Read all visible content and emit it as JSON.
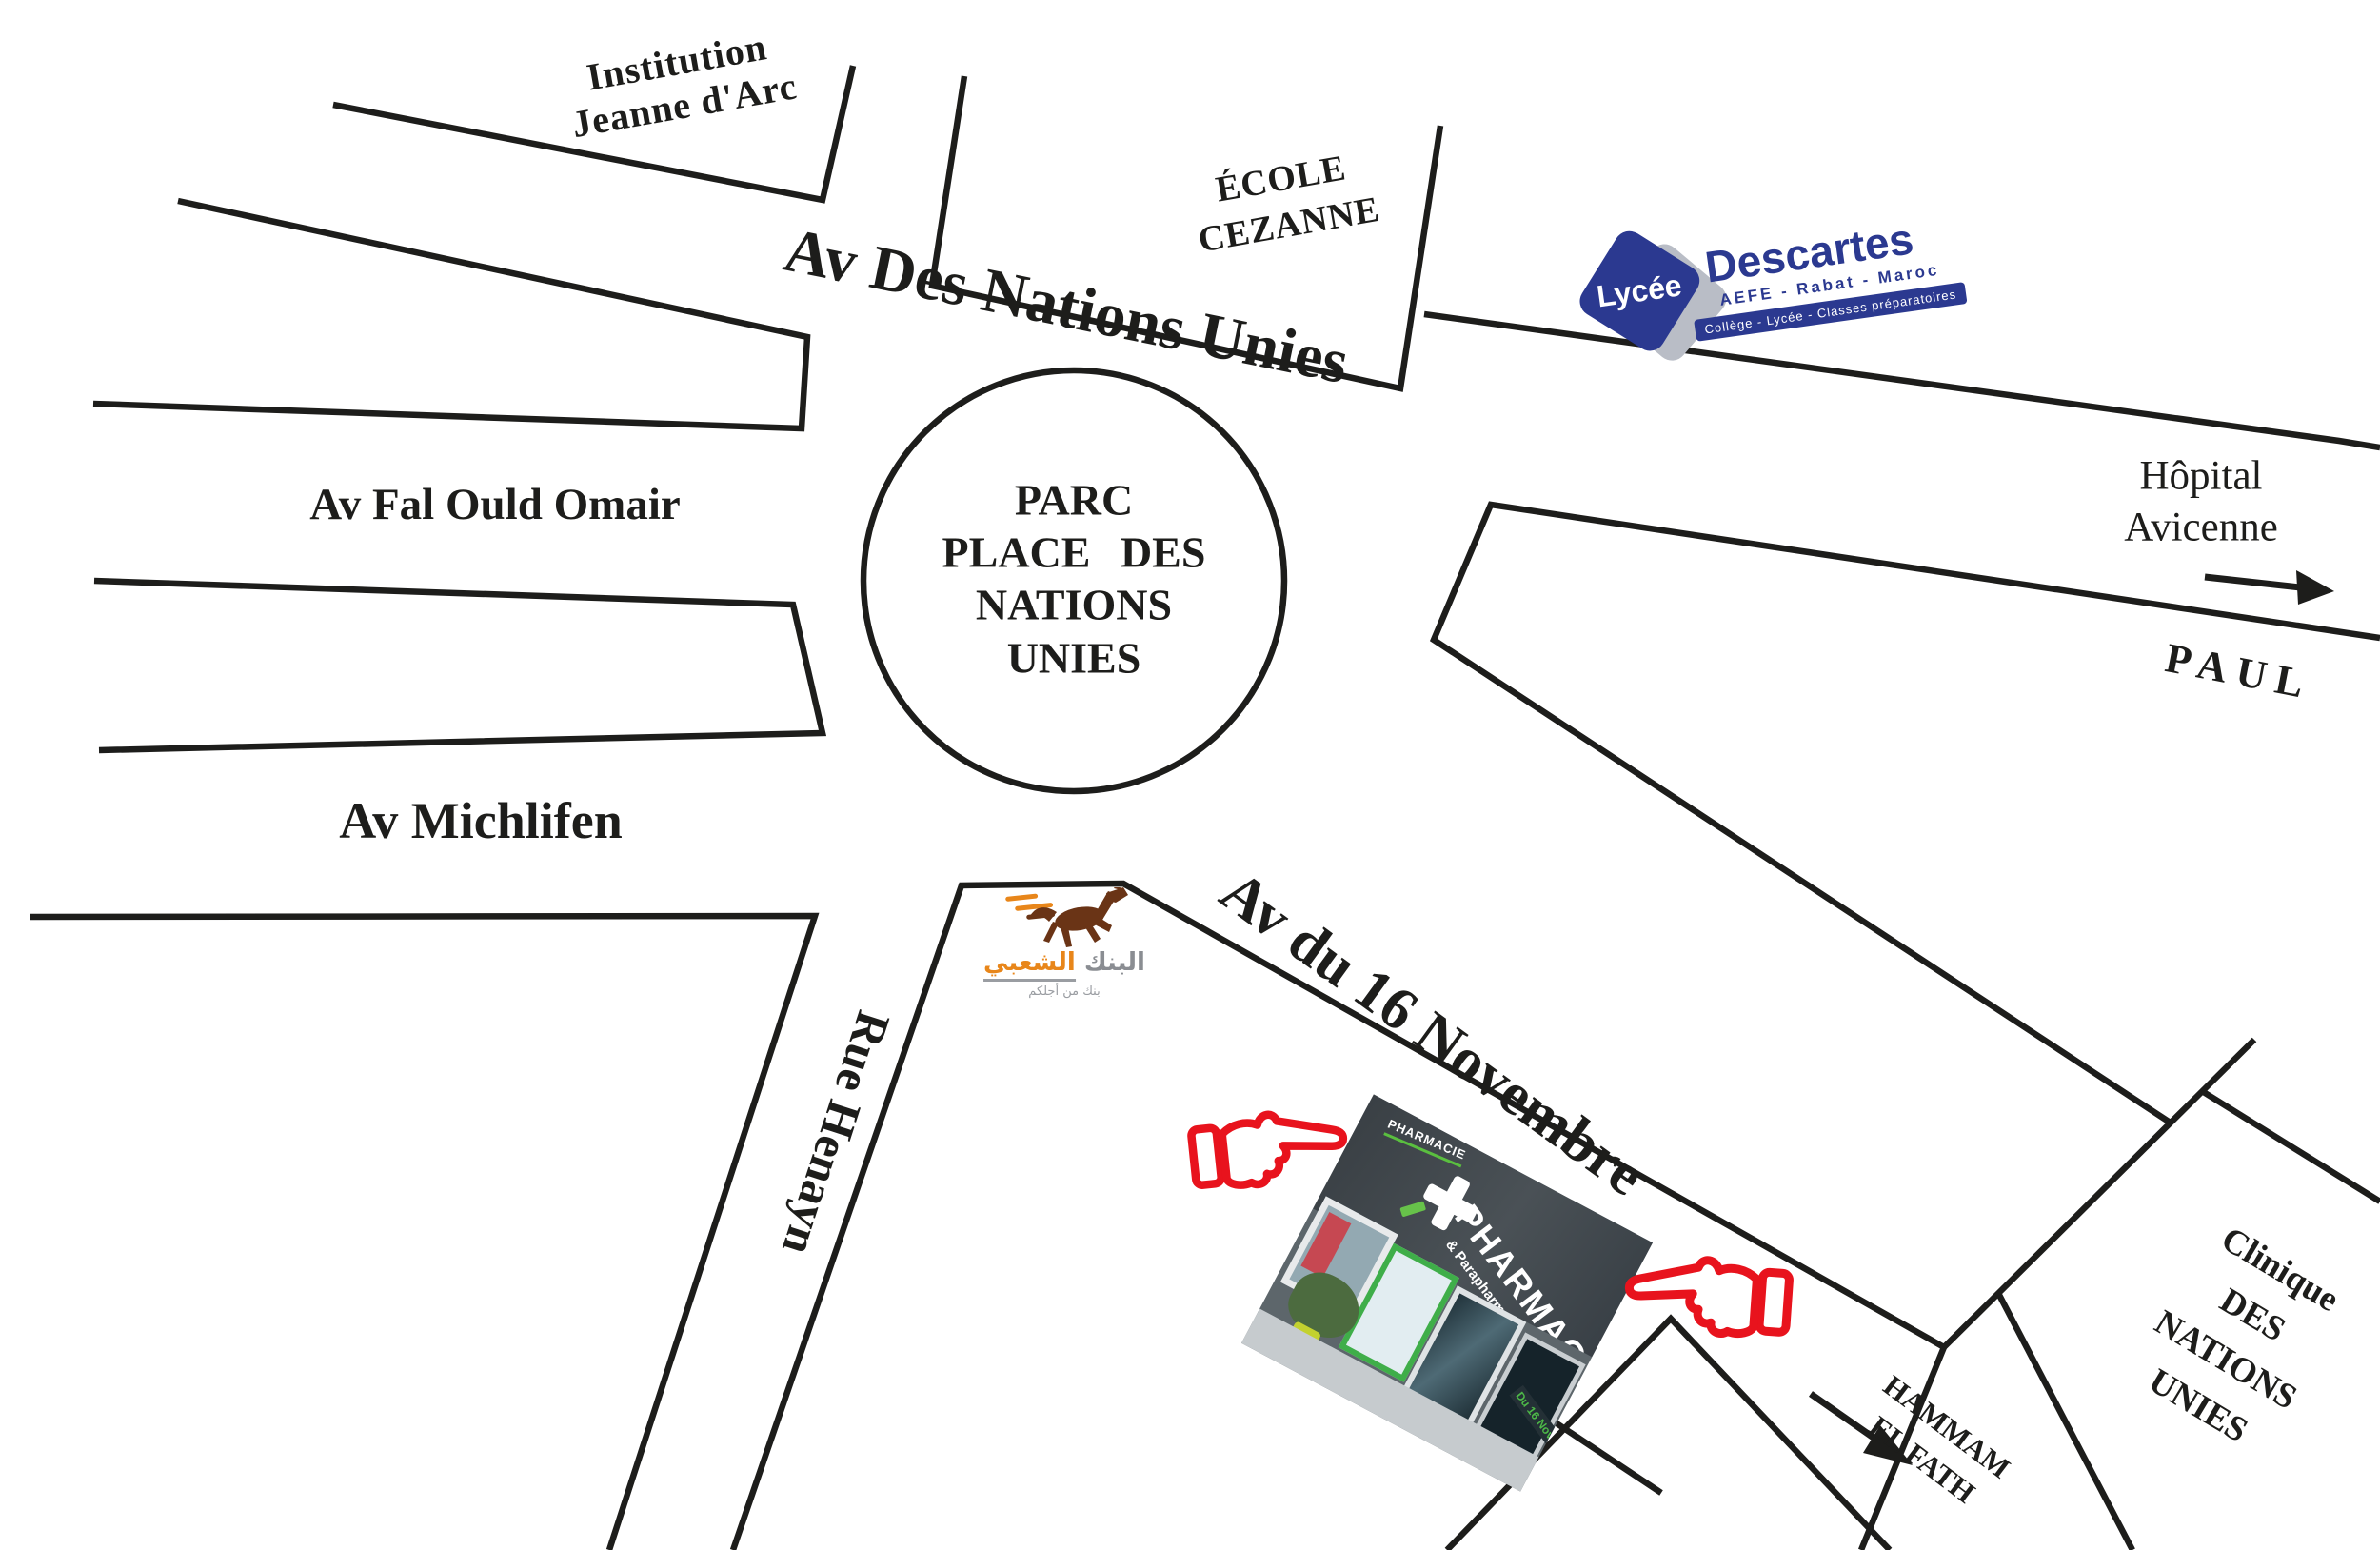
{
  "colors": {
    "ink": "#1d1d1b",
    "hand_red": "#e8131d",
    "descartes_blue": "#2b3990",
    "descartes_gray": "#b9bdc6",
    "bank_orange": "#e8861a",
    "bank_gray": "#8a8d92",
    "horse_brown": "#6a3416",
    "pharmacy_facade": "#4a5156",
    "pharmacy_green": "#3fae49"
  },
  "map": {
    "labels": {
      "institution": "Institution\nJeanne d'Arc",
      "av_des_nations_unies": "Av Des Nations Unies",
      "ecole_cezanne": "ÉCOLE\nCEZANNE",
      "parc_place": "PARC\nPLACE DES\nNATIONS\nUNIES",
      "av_fal_ould_omair": "Av Fal Ould Omair",
      "av_michlifen": "Av Michlifen",
      "rue_henayn": "Rue Henayn",
      "av_16_novembre": "Av du 16 Novembre",
      "hopital_avicenne": "Hôpital\nAvicenne",
      "paul": "PAUL",
      "hammam_el_fath": "HAMMAM\nEL FATH",
      "clinique": "Clinique\nDES\nNATIONS\nUNIES"
    },
    "descartes_logo": {
      "title": "Lycée",
      "title2": "Descartes",
      "subtitle": "AEFE - Rabat - Maroc",
      "banner": "Collège - Lycée - Classes préparatoires"
    },
    "bank_logo": {
      "name_first": "البنك",
      "name_second": "الشعبي",
      "tagline": "بنك من أجلكم"
    },
    "pharmacy_photo": {
      "top_sign": "PHARMACIE",
      "main_sign": "PHARMACIE",
      "sub_sign": "& Parapharmacie",
      "side_plate": "Du 16 Novembre"
    }
  }
}
